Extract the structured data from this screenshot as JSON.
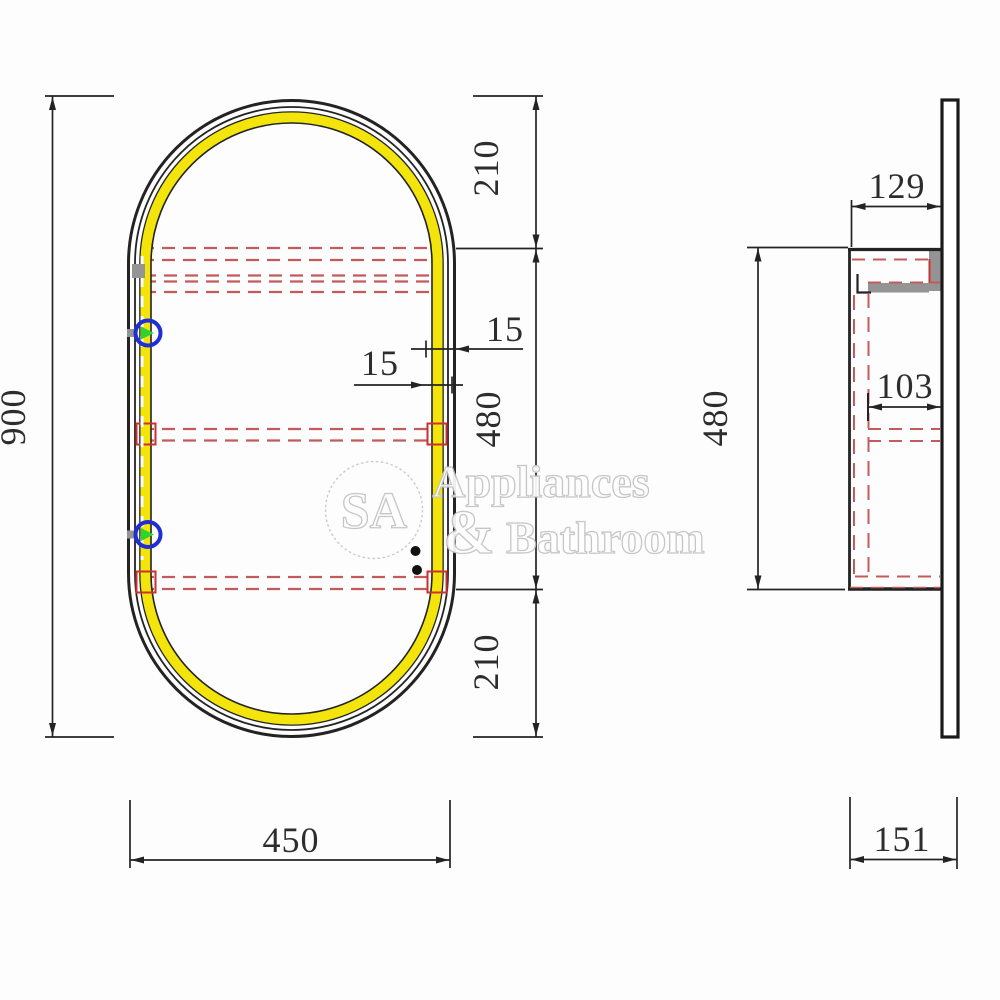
{
  "front_view": {
    "overall_height": "900",
    "overall_width": "450",
    "top_offset": "210",
    "cabinet_zone_height": "480",
    "bottom_offset": "210",
    "led_offset_upper": "15",
    "led_offset_lower": "15"
  },
  "side_view": {
    "cabinet_depth": "129",
    "inner_depth": "103",
    "cabinet_height": "480",
    "overall_depth": "151"
  },
  "watermark": {
    "monogram": "SA",
    "line1": "Appliances",
    "line2_amp": "&",
    "line2_rest": " Bathroom"
  },
  "colors": {
    "led_yellow": "#f3e50b",
    "hidden_line_red": "#c25b5b",
    "accent_red": "#cc3030",
    "hinge_blue": "#1f2fd4",
    "hinge_green": "#2fd32f",
    "line_black": "#232323",
    "hardware_gray": "#949494"
  }
}
